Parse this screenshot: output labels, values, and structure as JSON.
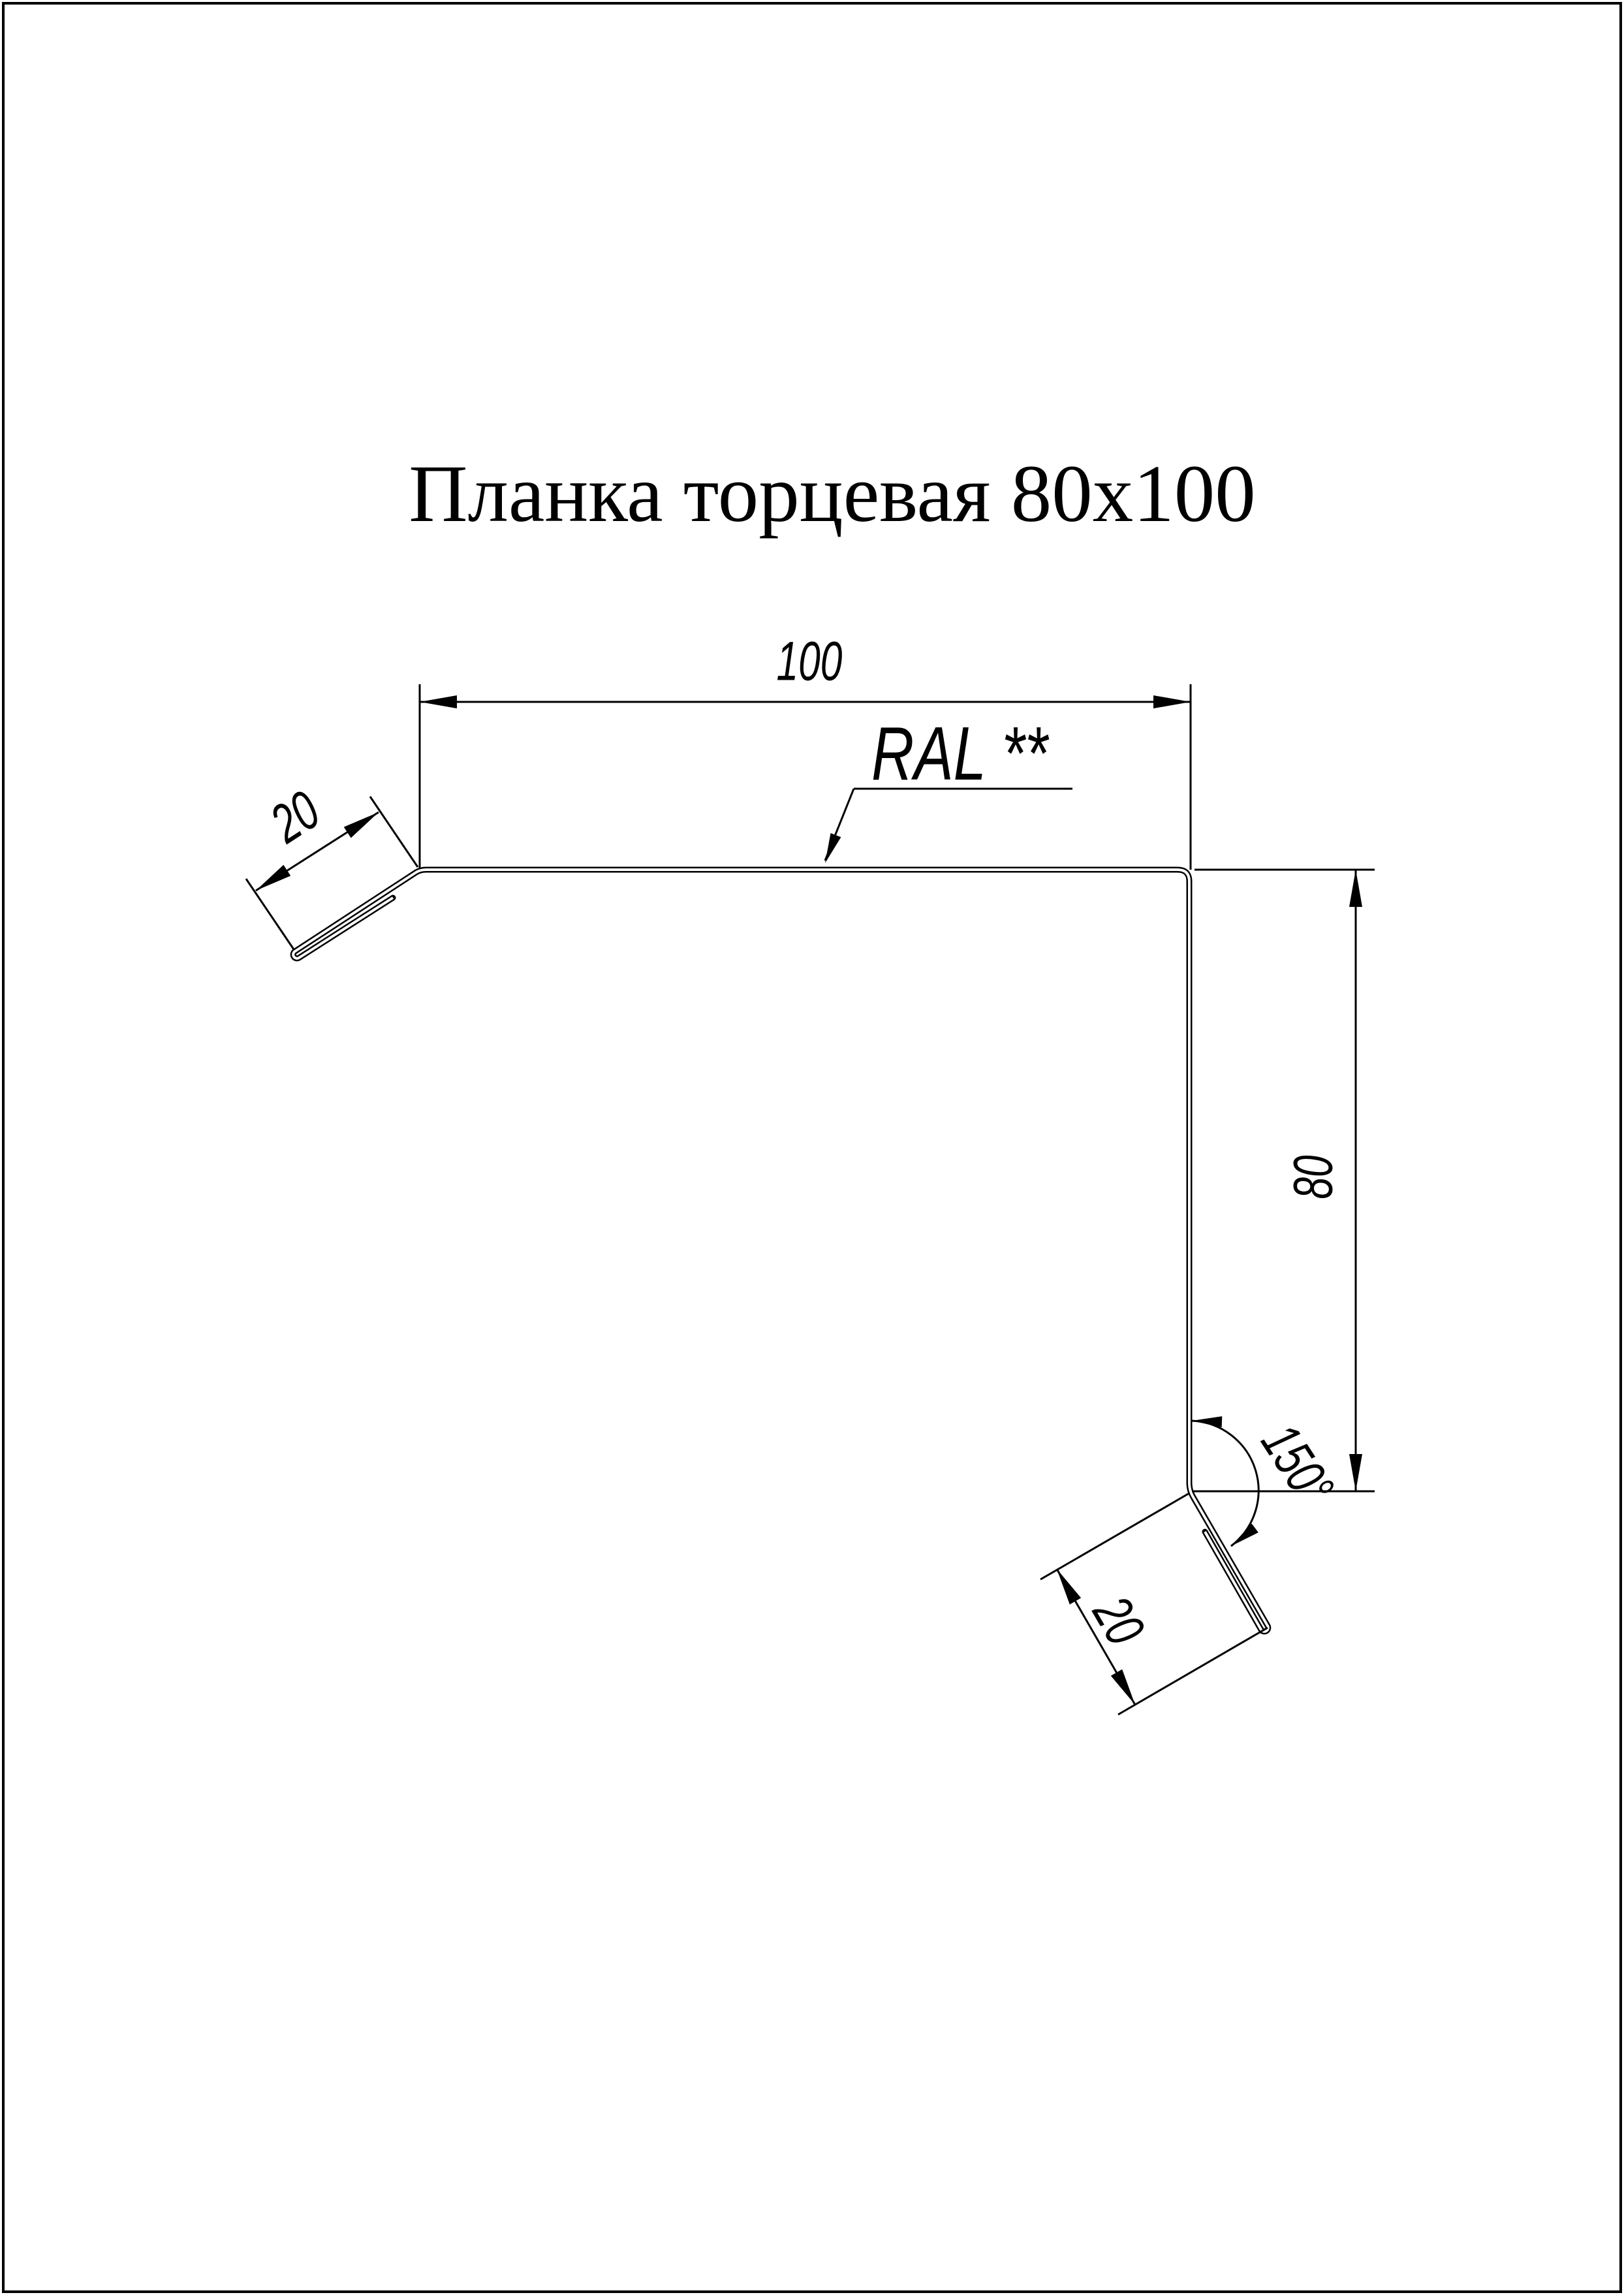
{
  "page": {
    "title": "Планка торцевая 80x100",
    "background_color": "#ffffff",
    "line_color": "#000000"
  },
  "drawing": {
    "labels": {
      "top_width": "100",
      "right_height": "80",
      "top_hem_length": "20",
      "bottom_hem_length": "20",
      "bend_angle": "150°",
      "color_note": "RAL **"
    }
  }
}
